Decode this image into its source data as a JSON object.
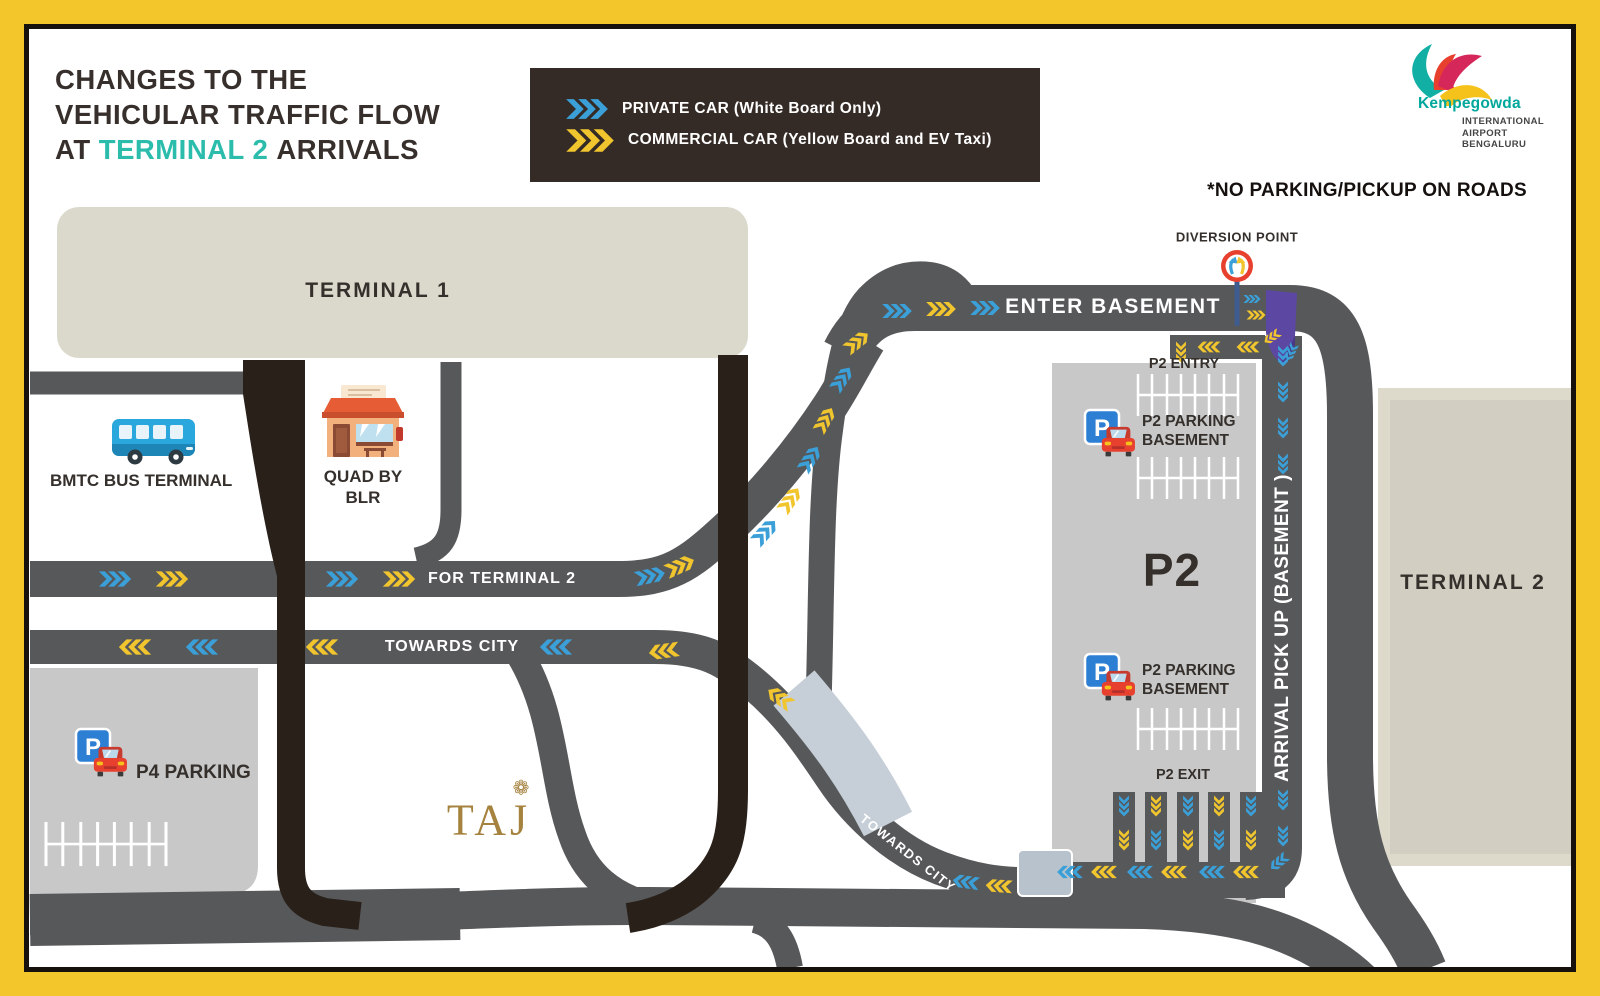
{
  "header": {
    "title": {
      "line1": "CHANGES TO THE",
      "line2": "VEHICULAR TRAFFIC FLOW",
      "line3_prefix": "AT",
      "line3_highlight": "TERMINAL 2",
      "line3_suffix": "ARRIVALS",
      "highlight_color": "#2BBCAC"
    },
    "note": "*NO PARKING/PICKUP ON ROADS"
  },
  "legend": {
    "background": "#352B26",
    "items": [
      {
        "label": "PRIVATE CAR (White Board Only)",
        "color": "#3B9FD8"
      },
      {
        "label": "COMMERCIAL CAR (Yellow Board and EV Taxi)",
        "color": "#F1C52D"
      }
    ]
  },
  "logo": {
    "name": "Kempegowda",
    "sub1": "INTERNATIONAL",
    "sub2": "AIRPORT",
    "sub3": "BENGALURU"
  },
  "map": {
    "labels": {
      "terminal1": "TERMINAL 1",
      "terminal2": "TERMINAL 2",
      "bmtc": "BMTC BUS TERMINAL",
      "quad_line1": "QUAD BY",
      "quad_line2": "BLR",
      "p4_parking": "P4 PARKING",
      "taj": "TAJ",
      "taj_flower": "❁",
      "for_terminal2": "FOR TERMINAL 2",
      "towards_city": "TOWARDS CITY",
      "towards_city_curved": "TOWARDS CITY",
      "enter_basement": "ENTER BASEMENT",
      "diversion_point": "DIVERSION POINT",
      "p2_entry": "P2 ENTRY",
      "p2_parking_line1": "P2 PARKING",
      "p2_parking_line2": "BASEMENT",
      "p2_big": "P2",
      "p2_exit": "P2 EXIT",
      "arrival_pickup": "ARRIVAL PICK UP (BASEMENT )",
      "parking_sign": "P"
    },
    "colors": {
      "road": "#57585A",
      "dark_road": "#2A201A",
      "terminal_fill": "#DBD8CC",
      "parking_fill": "#C8C8C8",
      "private_chevron": "#3B9FD8",
      "commercial_chevron": "#F1C52D",
      "basement_ramp": "#5C47A2",
      "diversion_sign": "#E8402F",
      "frame_border": "#F3C72B"
    }
  }
}
